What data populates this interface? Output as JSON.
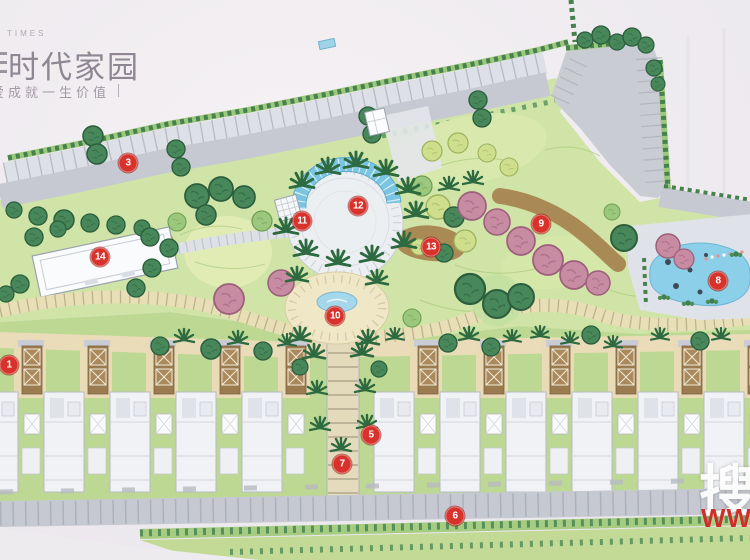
{
  "brand": {
    "small": "TIMES",
    "name": "时代家园",
    "tagline": "爱成就一生价值"
  },
  "watermark": {
    "char": "搜",
    "letters": "WWW"
  },
  "markers": [
    {
      "label": "1",
      "x": 9,
      "y": 365
    },
    {
      "label": "3",
      "x": 128,
      "y": 163
    },
    {
      "label": "5",
      "x": 371,
      "y": 435
    },
    {
      "label": "6",
      "x": 455,
      "y": 516
    },
    {
      "label": "7",
      "x": 342,
      "y": 464
    },
    {
      "label": "8",
      "x": 718,
      "y": 281
    },
    {
      "label": "9",
      "x": 541,
      "y": 224
    },
    {
      "label": "10",
      "x": 335,
      "y": 316
    },
    {
      "label": "11",
      "x": 302,
      "y": 221
    },
    {
      "label": "12",
      "x": 358,
      "y": 206
    },
    {
      "label": "13",
      "x": 431,
      "y": 247
    },
    {
      "label": "14",
      "x": 100,
      "y": 257
    }
  ],
  "colors": {
    "marker_red": "#d7322c",
    "water_blue": "#8ccfe9",
    "lawn_green": "#cfe4a6",
    "road_gray": "#c6c9d1",
    "walkway_cream": "#e9dfb6",
    "brand_gray": "#8e8793",
    "watermark_red": "#cf2f27"
  }
}
